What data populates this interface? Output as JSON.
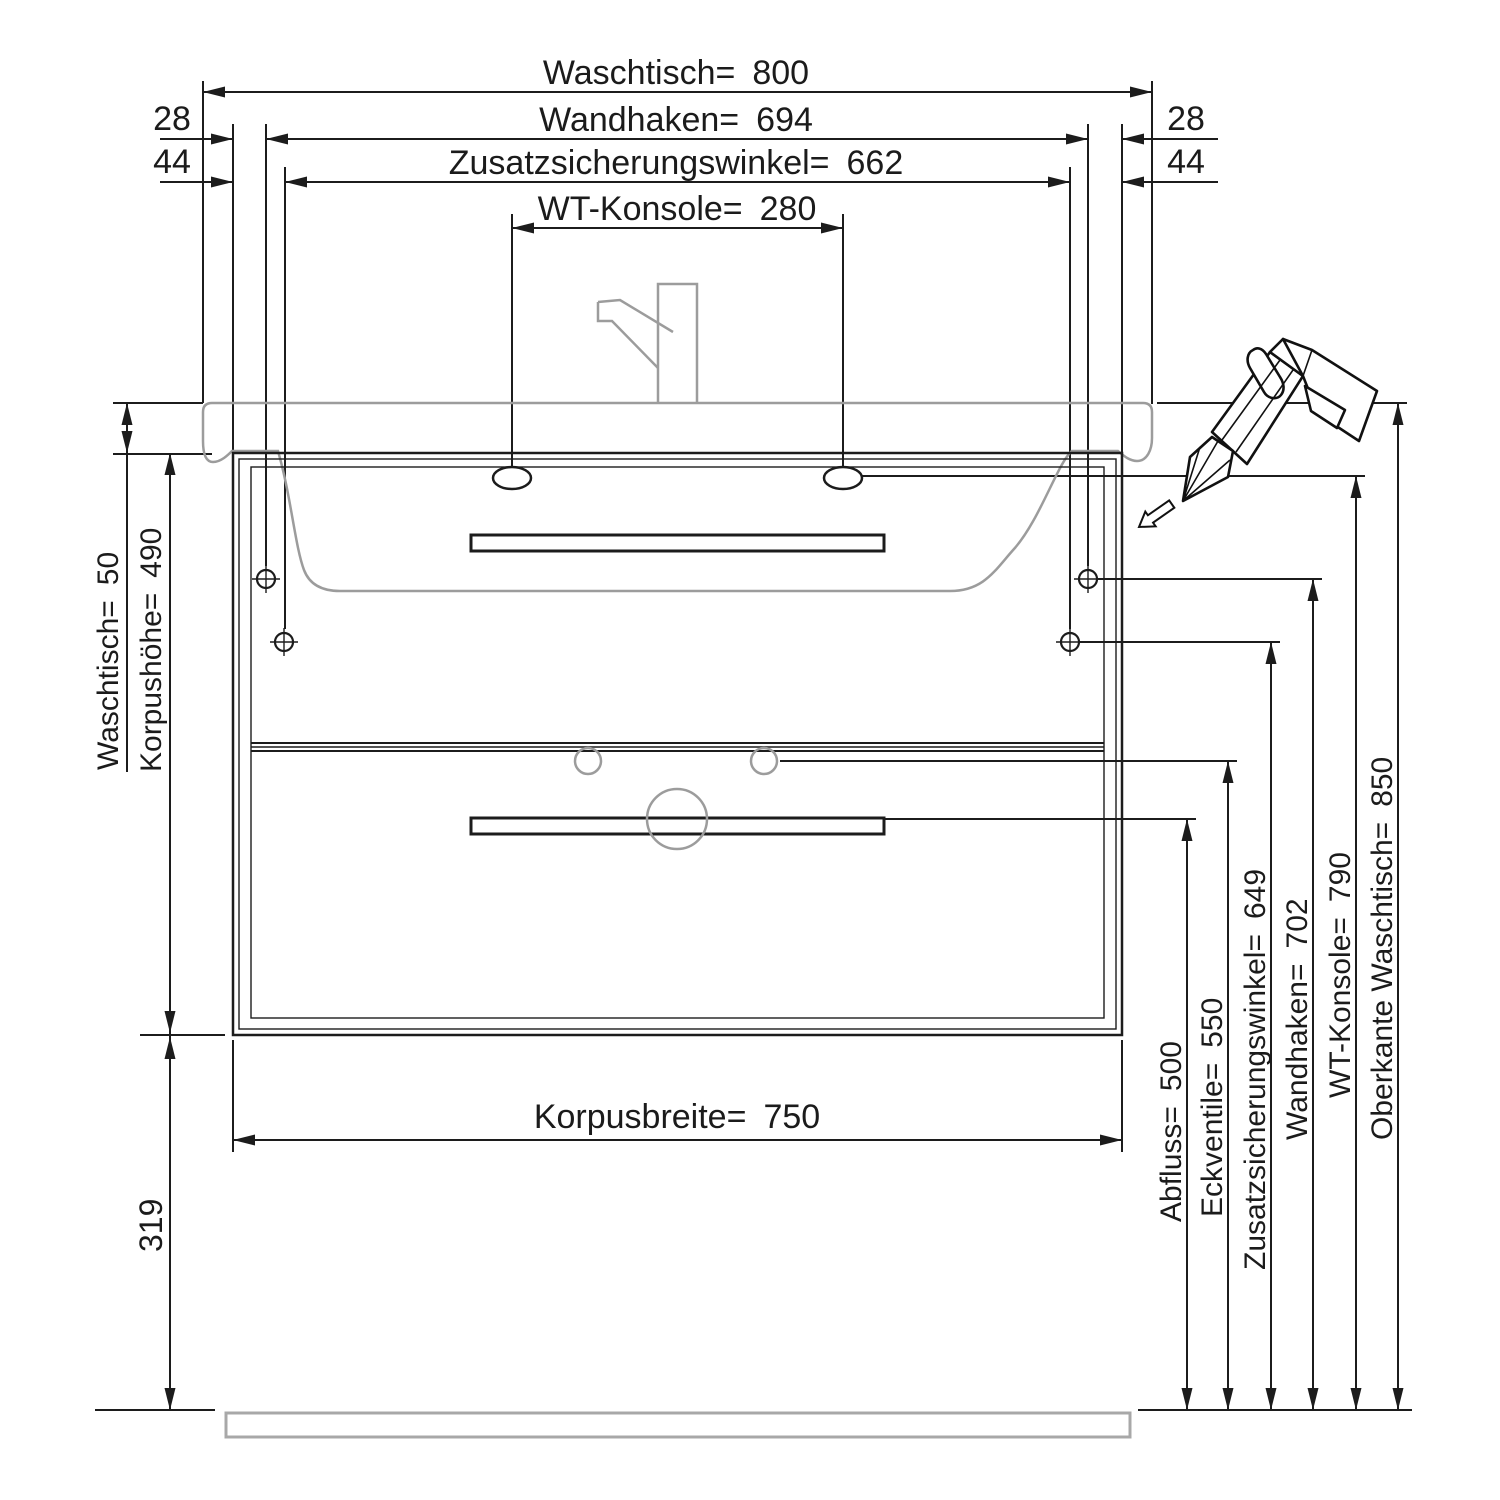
{
  "drawing_title": "Waschtisch-Montageplan",
  "dims": {
    "top": {
      "waschtisch": "Waschtisch= 800",
      "wandhaken": "Wandhaken= 694",
      "zusatzsicherungswinkel": "Zusatzsicherungswinkel= 662",
      "wt_konsole": "WT-Konsole= 280",
      "offset_28_left": "28",
      "offset_28_right": "28",
      "offset_44_left": "44",
      "offset_44_right": "44"
    },
    "left": {
      "waschtisch_dicke": "Waschtisch= 50",
      "korpushoehe": "Korpushöhe= 490",
      "bodenabstand": "319"
    },
    "bottom": {
      "korpusbreite": "Korpusbreite= 750"
    },
    "right": {
      "abfluss": "Abfluss= 500",
      "eckventile": "Eckventile= 550",
      "zusatzsicherungswinkel": "Zusatzsicherungswinkel= 649",
      "wandhaken": "Wandhaken= 702",
      "wt_konsole": "WT-Konsole= 790",
      "oberkante_waschtisch": "Oberkante Waschtisch= 850"
    }
  },
  "values": {
    "waschtisch_breite_mm": 800,
    "wandhaken_abstand_mm": 694,
    "zusatzsicherungswinkel_abstand_mm": 662,
    "wt_konsole_abstand_mm": 280,
    "seitenoffset_wandhaken_mm": 28,
    "seitenoffset_winkel_mm": 44,
    "waschtisch_dicke_mm": 50,
    "korpushoehe_mm": 490,
    "bodenabstand_mm": 319,
    "korpusbreite_mm": 750,
    "abfluss_hoehe_mm": 500,
    "eckventile_hoehe_mm": 550,
    "zusatzsicherungswinkel_hoehe_mm": 649,
    "wandhaken_hoehe_mm": 702,
    "wt_konsole_hoehe_mm": 790,
    "oberkante_waschtisch_hoehe_mm": 850
  },
  "colors": {
    "line": "#1c1c1c",
    "secondary_outline": "#9c9c9c",
    "background": "#ffffff"
  },
  "icons": {
    "wall_hook_symbol": "crosshair-circle",
    "tool_illustration": "caulk-gun",
    "direction_arrow": "outline-arrow-down-left"
  }
}
